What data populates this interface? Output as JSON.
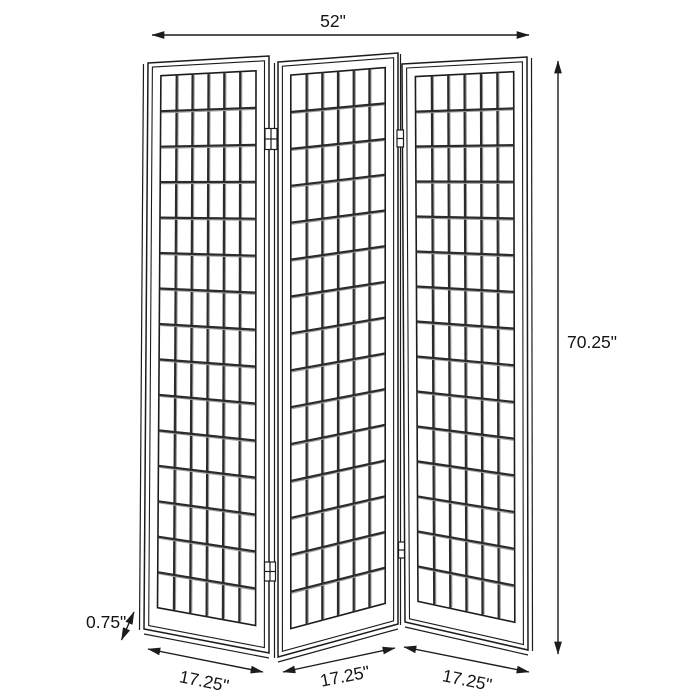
{
  "diagram": {
    "type": "furniture-dimension-drawing",
    "subject": "3-panel folding shoji room divider screen",
    "panel_count": 3,
    "grid_columns": 6,
    "grid_rows": 15
  },
  "dimensions": {
    "total_width": "52\"",
    "height": "70.25\"",
    "panel_thickness": "0.75\"",
    "panel_width_left": "17.25\"",
    "panel_width_middle": "17.25\"",
    "panel_width_right": "17.25\""
  },
  "colors": {
    "background": "#ffffff",
    "line": "#1c1c1c",
    "mullion": "#2b2b2b",
    "mullion_shade": "#9e9e9e"
  }
}
